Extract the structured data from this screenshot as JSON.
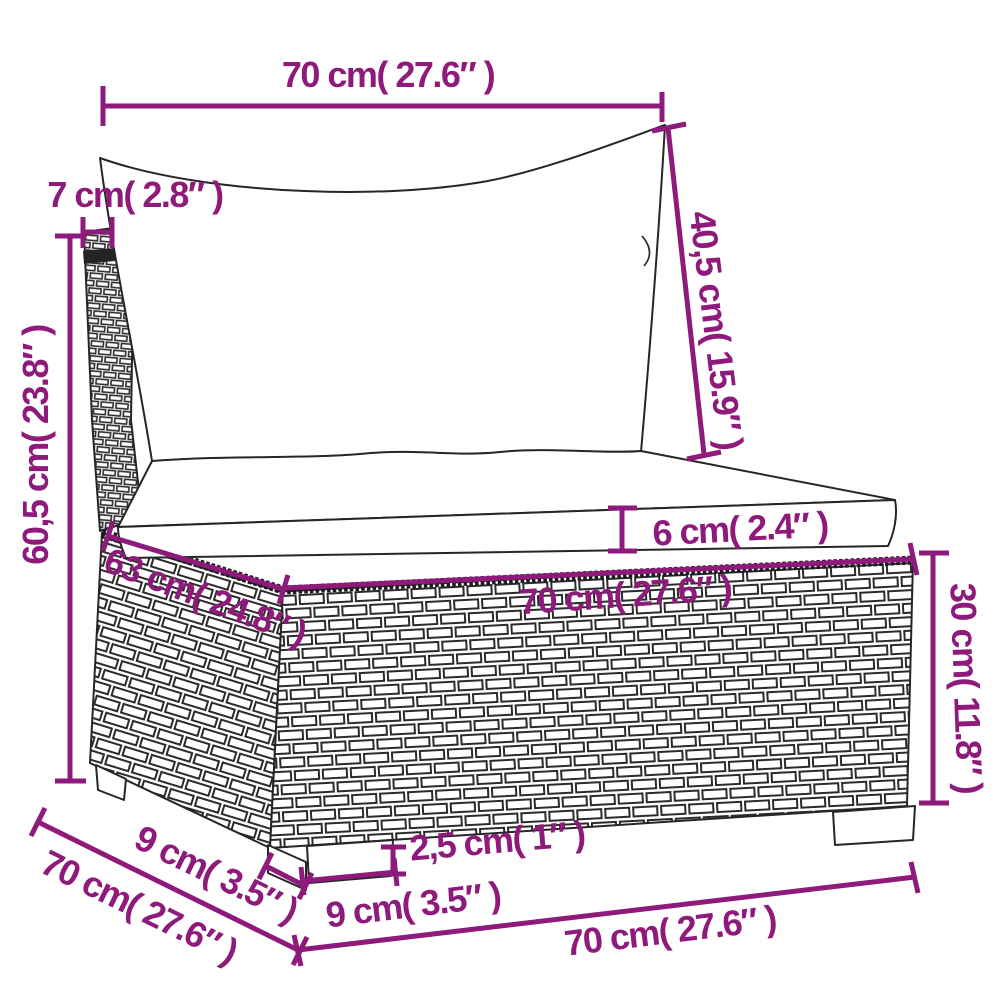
{
  "diagram": {
    "type": "product-dimension-diagram",
    "subject": "rattan-garden-sofa-middle-section-with-cushions",
    "accent_color": "#8e1a7b",
    "sketch_color": "#262626",
    "background_color": "#ffffff",
    "labels": {
      "back_cushion_width": "70 cm( 27.6″ )",
      "armrest_post_width": "7 cm( 2.8″ )",
      "back_cushion_height": "40,5 cm( 15.9″ )",
      "total_height": "60,5 cm( 23.8″ )",
      "seat_cushion_thickness": "6 cm( 2.4″ )",
      "seat_depth": "63 cm( 24.8″ )",
      "seat_width": "70 cm( 27.6″ )",
      "base_height": "30 cm( 11.8″ )",
      "foot_height": "2,5 cm( 1″ )",
      "front_foot_width": "9 cm( 3.5″ )",
      "side_foot_width": "9 cm( 3.5″ )",
      "side_depth": "70 cm( 27.6″ )",
      "front_width": "70 cm( 27.6″ )"
    }
  }
}
